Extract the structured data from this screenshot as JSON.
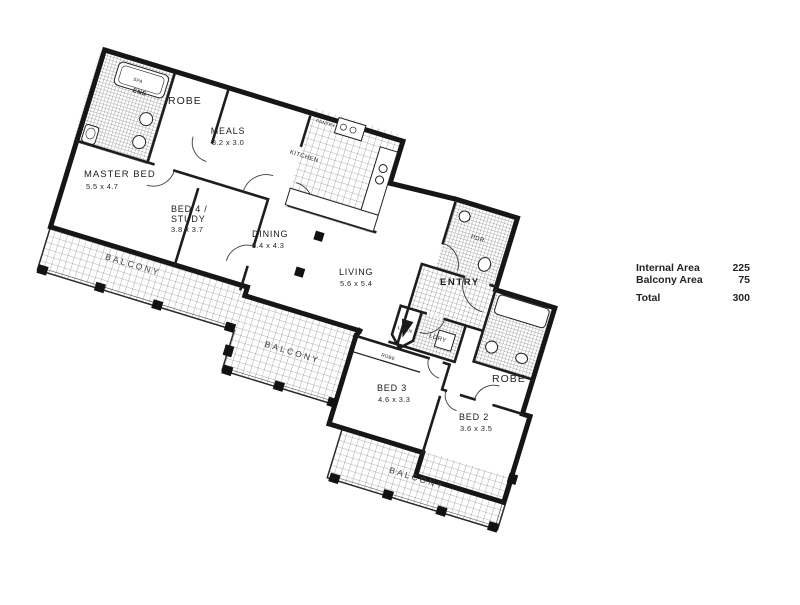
{
  "plan": {
    "rooms": {
      "ens": {
        "label": "ENS"
      },
      "spa": {
        "label": "SPA"
      },
      "robe_master": {
        "label": "ROBE"
      },
      "meals": {
        "label": "MEALS",
        "dims": "3.2 x 3.0"
      },
      "kitchen": {
        "label": "KITCHEN"
      },
      "pantry": {
        "label": "PANTRY"
      },
      "master_bed": {
        "label": "MASTER BED",
        "dims": "5.5 x 4.7"
      },
      "bed4": {
        "line1": "BED 4 /",
        "line2": "STUDY",
        "dims": "3.8 x 3.7"
      },
      "dining": {
        "label": "DINING",
        "dims": "5.4 x 4.3"
      },
      "living": {
        "label": "LIVING",
        "dims": "5.6 x 5.4"
      },
      "pdr": {
        "label": "PDR"
      },
      "entry": {
        "label": "ENTRY"
      },
      "ldry": {
        "label": "LDRY"
      },
      "linen": {
        "label": "LINEN"
      },
      "bed3": {
        "label": "BED 3",
        "dims": "4.6 x 3.3"
      },
      "bed2": {
        "label": "BED 2",
        "dims": "3.6 x 3.5"
      },
      "robe_bed2": {
        "label": "ROBE"
      },
      "robe_bed3": {
        "label": "ROBE"
      }
    },
    "balconies": {
      "left": "BALCONY",
      "middle": "BALCONY",
      "bottom": "BALCONY"
    }
  },
  "area_table": {
    "rows": [
      {
        "label": "Internal Area",
        "value": "225"
      },
      {
        "label": "Balcony Area",
        "value": "75"
      }
    ],
    "total": {
      "label": "Total",
      "value": "300"
    }
  },
  "colors": {
    "ink": "#1a1a1a",
    "paper": "#ffffff",
    "hatch": "#5f5f5f"
  }
}
